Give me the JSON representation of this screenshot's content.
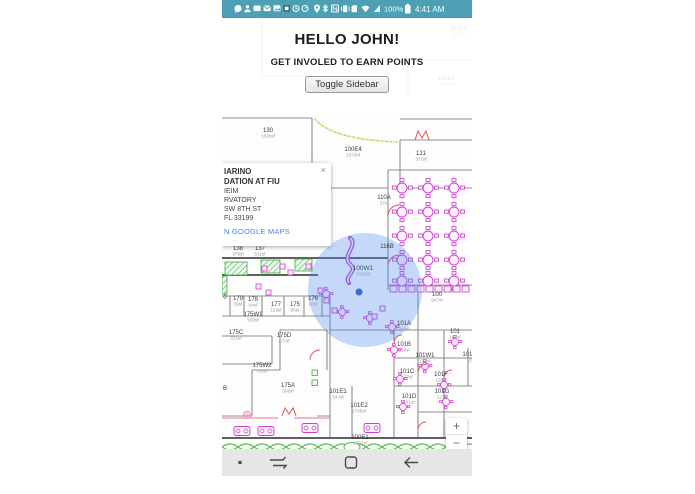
{
  "status_bar": {
    "battery_percent": "100%",
    "time": "4:41 AM",
    "bg_color": "#4d9fb3"
  },
  "header": {
    "greeting": "HELLO JOHN!",
    "subtitle": "GET INVOLED TO EARN POINTS",
    "toggle_button": "Toggle Sidebar"
  },
  "popup": {
    "title_lines": [
      "IARINO",
      "DATION AT FIU"
    ],
    "detail_lines": [
      "IEIM",
      "RVATORY",
      "SW 8TH ST",
      "FL 33199"
    ],
    "link": "N GOOGLE MAPS",
    "close_glyph": "×"
  },
  "map": {
    "zoom_in_label": "+",
    "zoom_out_label": "−",
    "location": {
      "room": "100W1",
      "area": "3592sf",
      "x": 141,
      "y": 252
    },
    "accent_blue": "#4285f4",
    "rooms": [
      {
        "label": "100E3",
        "sf": "1900sf",
        "x": 236,
        "y": 12
      },
      {
        "label": "100E5",
        "sf": "1175sf",
        "x": 224,
        "y": 62
      },
      {
        "label": "130",
        "sf": "1628sf",
        "x": 46,
        "y": 114
      },
      {
        "label": "100E4",
        "sf": "2373sf",
        "x": 131,
        "y": 133
      },
      {
        "label": "121",
        "sf": "372sf",
        "x": 199,
        "y": 137
      },
      {
        "label": "110A",
        "sf": "37sf",
        "x": 162,
        "y": 181
      },
      {
        "label": "138",
        "sf": "379sf",
        "x": 16,
        "y": 232
      },
      {
        "label": "137",
        "sf": "511sf",
        "x": 38,
        "y": 232
      },
      {
        "label": "116B",
        "sf": "",
        "x": 165,
        "y": 230
      },
      {
        "label": "0",
        "sf": "",
        "x": 3,
        "y": 281
      },
      {
        "label": "179",
        "sf": "39sf",
        "x": 16,
        "y": 282
      },
      {
        "label": "178",
        "sf": "64sf",
        "x": 31,
        "y": 283
      },
      {
        "label": "177",
        "sf": "119sf",
        "x": 54,
        "y": 288
      },
      {
        "label": "175",
        "sf": "85sf",
        "x": 73,
        "y": 288
      },
      {
        "label": "176",
        "sf": "60sf",
        "x": 91,
        "y": 282
      },
      {
        "label": "175W1",
        "sf": "500sf",
        "x": 31,
        "y": 298
      },
      {
        "label": "100",
        "sf": "547sf",
        "x": 215,
        "y": 278
      },
      {
        "label": "175C",
        "sf": "221sf",
        "x": 14,
        "y": 316
      },
      {
        "label": "175D",
        "sf": "477sf",
        "x": 62,
        "y": 319
      },
      {
        "label": "101A",
        "sf": "343sf",
        "x": 182,
        "y": 307
      },
      {
        "label": "101",
        "sf": "107sf",
        "x": 233,
        "y": 315
      },
      {
        "label": "101B",
        "sf": "160sf",
        "x": 182,
        "y": 328
      },
      {
        "label": "101W1",
        "sf": "194sf",
        "x": 203,
        "y": 339
      },
      {
        "label": "101E3",
        "sf": "22",
        "x": 249,
        "y": 338
      },
      {
        "label": "175W2",
        "sf": "700sf",
        "x": 40,
        "y": 349
      },
      {
        "label": "101C",
        "sf": "177sf",
        "x": 185,
        "y": 355
      },
      {
        "label": "101F",
        "sf": "150sf",
        "x": 219,
        "y": 358
      },
      {
        "label": "175A",
        "sf": "508sf",
        "x": 66,
        "y": 369
      },
      {
        "label": "B",
        "sf": "",
        "x": 3,
        "y": 372
      },
      {
        "label": "101E1",
        "sf": "547sf",
        "x": 116,
        "y": 375
      },
      {
        "label": "101D",
        "sf": "191sf",
        "x": 187,
        "y": 380
      },
      {
        "label": "101G",
        "sf": "112sf",
        "x": 220,
        "y": 375
      },
      {
        "label": "101E2",
        "sf": "2795sf",
        "x": 137,
        "y": 389
      },
      {
        "label": "100E1",
        "sf": "1702sf",
        "x": 138,
        "y": 421
      }
    ]
  },
  "attribution": {
    "logo_letters": [
      {
        "ch": "G",
        "color": "#4285F4"
      },
      {
        "ch": "o",
        "color": "#EA4335"
      },
      {
        "ch": "o",
        "color": "#FBBC05"
      },
      {
        "ch": "g",
        "color": "#4285F4"
      },
      {
        "ch": "l",
        "color": "#34A853"
      },
      {
        "ch": "e",
        "color": "#EA4335"
      }
    ],
    "map_data": "MAP DATA ©2018 GOOGLE",
    "terms": "TERMS OF USE"
  }
}
